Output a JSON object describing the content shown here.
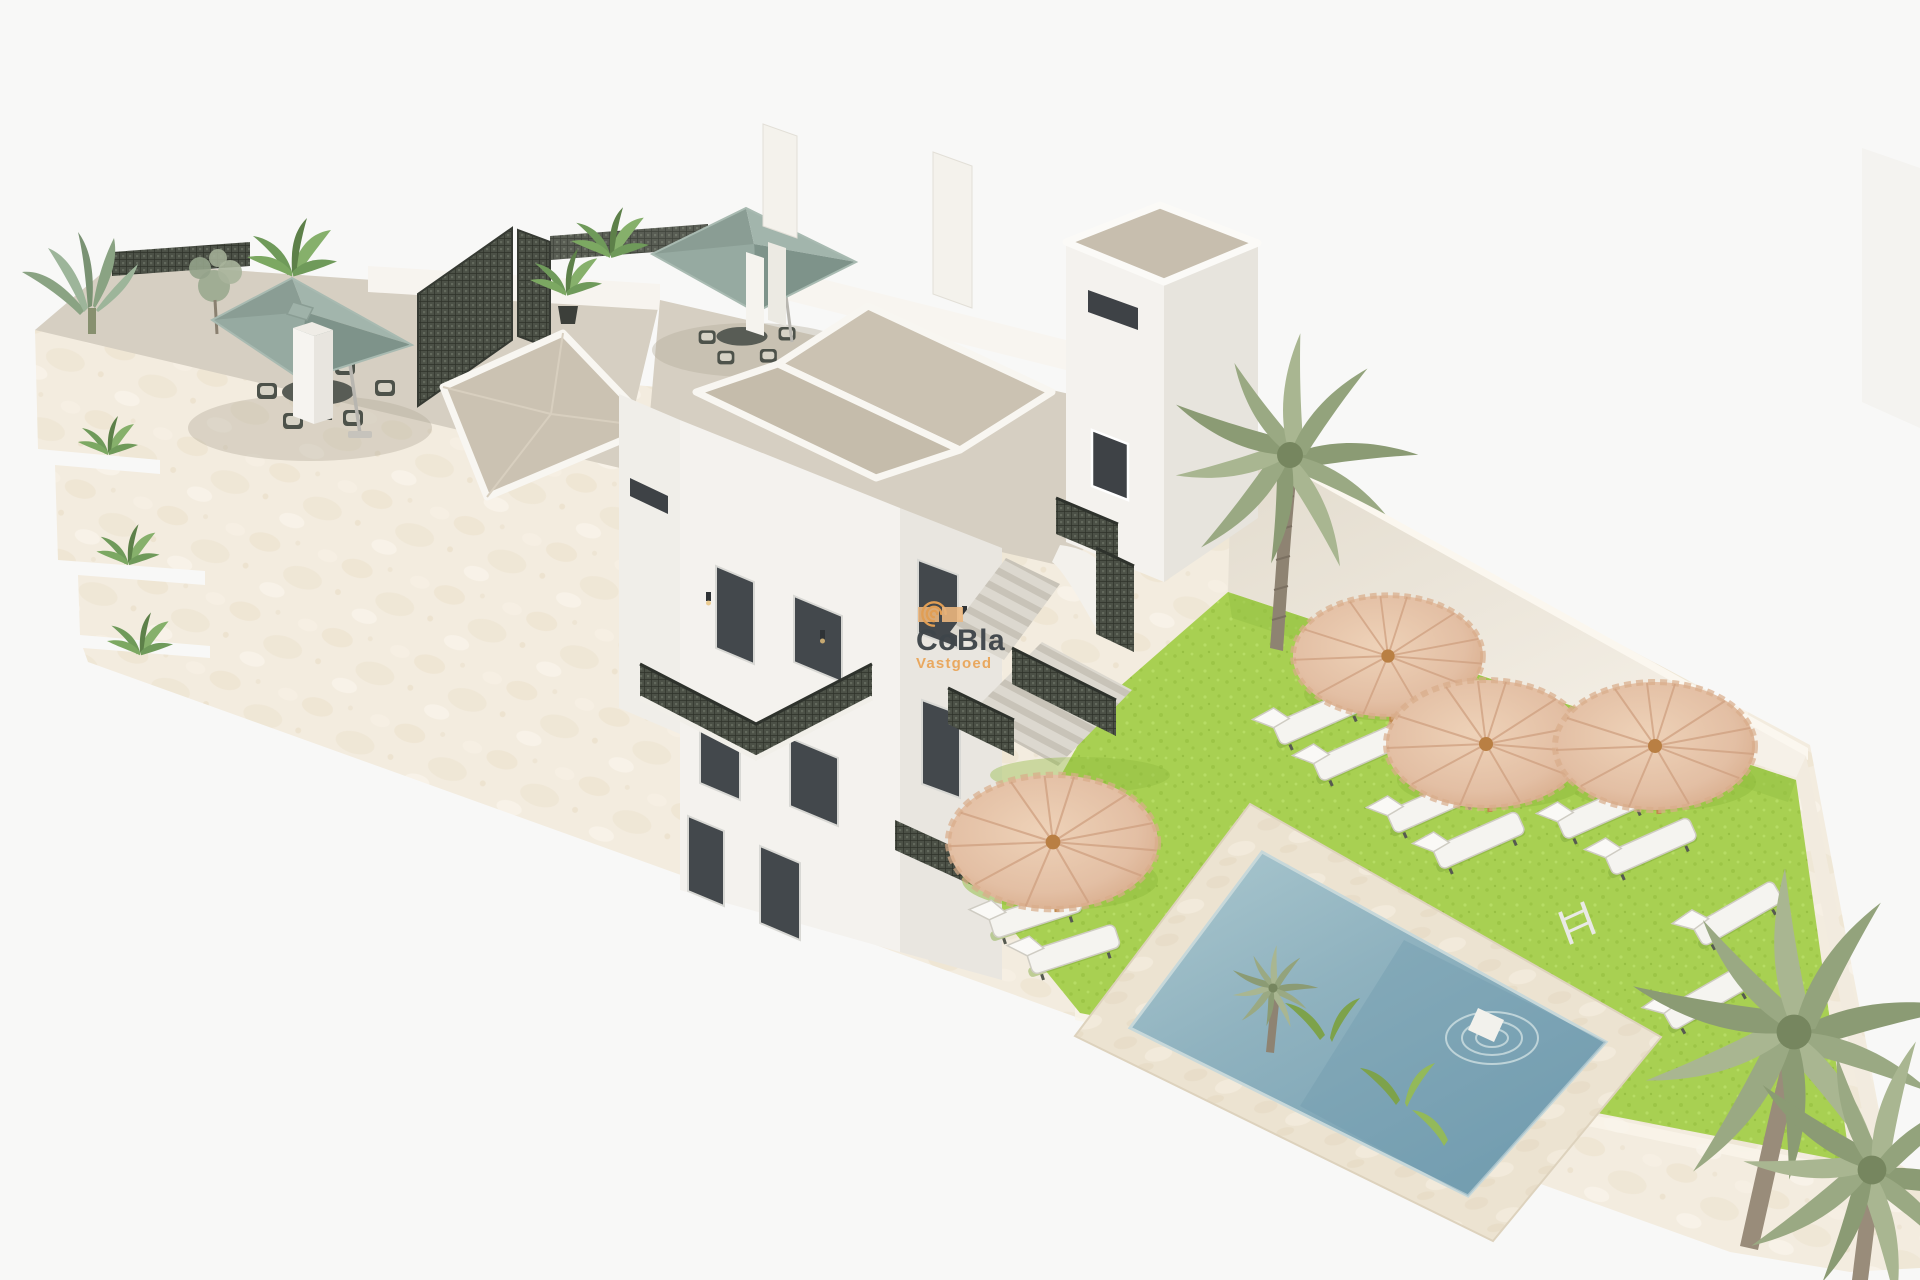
{
  "page": {
    "kind": "3d-architectural-exterior-render",
    "canvas": {
      "width": 1920,
      "height": 1280
    },
    "background_color": "#f8f8f7"
  },
  "watermark": {
    "brand": "CoBla",
    "subtitle": "Vastgoed",
    "brand_color": "#3e454a",
    "subtitle_color": "#e9a65a",
    "logo_icon": "spiral-swirl-icon",
    "logo_accent_color": "#e8a255",
    "logo_bar_color": "#edb77e"
  },
  "scene": {
    "description": "Aerial 3D render of a white Mediterranean apartment building with roof terraces, cream perimeter wall, communal lawn garden and swimming pool",
    "colors": {
      "wall_cream": "#f3ecdf",
      "building_white": "#f4f2ee",
      "terrace_floor": "#d6cfc2",
      "roof_beige": "#cbc2b2",
      "umbrella_sage": "#8fa49a",
      "grass_green": "#a8d052",
      "pool_water": "#8fb2bf",
      "pool_deck": "#ece3d1",
      "parasol_thatch": "#e3bfa4",
      "lattice_dark": "#4a5046"
    },
    "objects": [
      {
        "name": "roof-terrace",
        "count": 2,
        "features": [
          "sage-green square umbrella",
          "outdoor dining set",
          "potted plants",
          "dark lattice privacy screens"
        ]
      },
      {
        "name": "perimeter-wall",
        "material": "cream stucco",
        "planter_steps": 3
      },
      {
        "name": "tower-block",
        "windows": [
          "slot window",
          "framed window"
        ]
      },
      {
        "name": "external-staircase",
        "railing": "dark lattice"
      },
      {
        "name": "lawn-garden",
        "thatch_parasols": 4,
        "sun_loungers": 10
      },
      {
        "name": "swimming-pool",
        "features": [
          "stone deck",
          "chrome ladder",
          "in-water step",
          "ripples"
        ]
      },
      {
        "name": "palm-tree",
        "count": 3
      },
      {
        "name": "pool-corner-planting",
        "items": [
          "small palm",
          "shrubs"
        ]
      }
    ]
  }
}
